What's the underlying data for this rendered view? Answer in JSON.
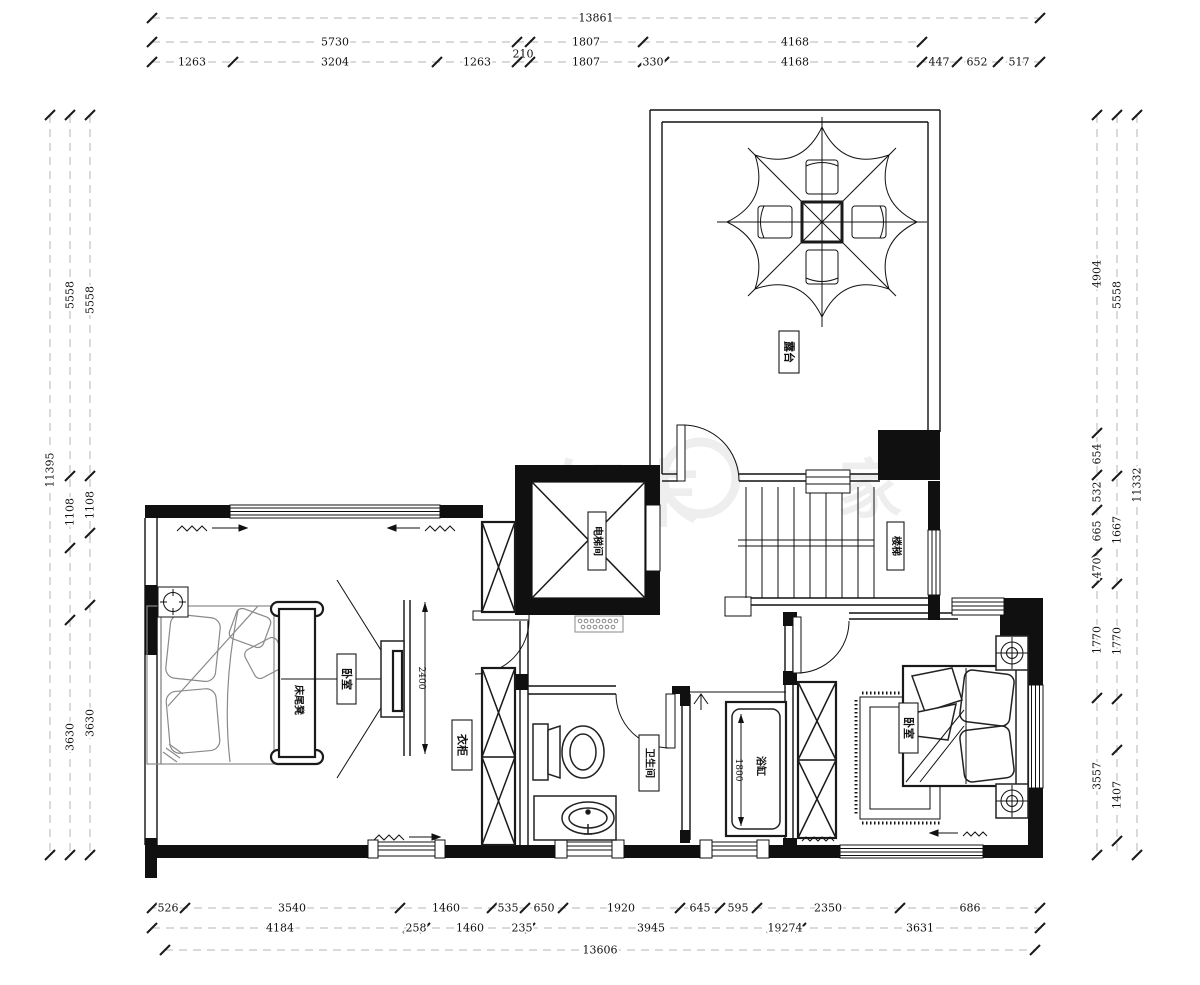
{
  "watermark": {
    "brand": "知末",
    "char": "家"
  },
  "labels": {
    "terrace": "露台",
    "elevator": "电梯间",
    "stairs": "楼梯",
    "bench": "床尾凳",
    "bedroom_left": "卧室",
    "wardrobe": "衣柜",
    "bathroom": "卫生间",
    "bathtub": "浴缸",
    "bedroom_right": "卧室",
    "tv_dim": "2400",
    "tub_dim": "1800"
  },
  "dimensions": {
    "horizontal": [
      {
        "y": 18,
        "x1": 152,
        "x2": 1040,
        "ticks": [
          152,
          1040
        ],
        "labels": [
          {
            "v": "13861",
            "x": 596
          }
        ]
      },
      {
        "y": 42,
        "x1": 152,
        "x2": 922,
        "ticks": [
          152,
          517,
          530,
          643,
          922
        ],
        "labels": [
          {
            "v": "5730",
            "x": 335
          },
          {
            "v": "210",
            "x": 523,
            "dy": 12
          },
          {
            "v": "1807",
            "x": 586
          },
          {
            "v": "4168",
            "x": 795
          }
        ]
      },
      {
        "y": 62,
        "x1": 152,
        "x2": 1040,
        "ticks": [
          152,
          233,
          437,
          517,
          530,
          643,
          664,
          922,
          957,
          998,
          1040
        ],
        "labels": [
          {
            "v": "1263",
            "x": 192
          },
          {
            "v": "3204",
            "x": 335
          },
          {
            "v": "1263",
            "x": 477
          },
          {
            "v": "1807",
            "x": 586
          },
          {
            "v": "330",
            "x": 653
          },
          {
            "v": "4168",
            "x": 795
          },
          {
            "v": "447",
            "x": 939
          },
          {
            "v": "652",
            "x": 977
          },
          {
            "v": "517",
            "x": 1019
          }
        ]
      },
      {
        "y": 908,
        "x1": 152,
        "x2": 1040,
        "ticks": [
          152,
          185,
          400,
          492,
          525,
          563,
          680,
          720,
          757,
          900,
          1040
        ],
        "labels": [
          {
            "v": "526",
            "x": 168
          },
          {
            "v": "3540",
            "x": 292
          },
          {
            "v": "1460",
            "x": 446
          },
          {
            "v": "535",
            "x": 508
          },
          {
            "v": "650",
            "x": 544
          },
          {
            "v": "1920",
            "x": 621
          },
          {
            "v": "645",
            "x": 700
          },
          {
            "v": "595",
            "x": 738
          },
          {
            "v": "2350",
            "x": 828
          },
          {
            "v": "686",
            "x": 970
          }
        ]
      },
      {
        "y": 928,
        "x1": 152,
        "x2": 1040,
        "ticks": [
          152,
          408,
          425,
          515,
          530,
          772,
          784,
          801,
          1040
        ],
        "labels": [
          {
            "v": "4184",
            "x": 280
          },
          {
            "v": "258",
            "x": 416
          },
          {
            "v": "1460",
            "x": 470
          },
          {
            "v": "235",
            "x": 522
          },
          {
            "v": "3945",
            "x": 651
          },
          {
            "v": "192",
            "x": 778
          },
          {
            "v": "274",
            "x": 792
          },
          {
            "v": "3631",
            "x": 920
          }
        ]
      },
      {
        "y": 950,
        "x1": 165,
        "x2": 1035,
        "ticks": [
          165,
          1035
        ],
        "labels": [
          {
            "v": "13606",
            "x": 600
          }
        ]
      }
    ],
    "vertical": [
      {
        "x": 50,
        "y1": 115,
        "y2": 855,
        "ticks": [
          115,
          855
        ],
        "labels": [
          {
            "v": "11395",
            "y": 470
          }
        ]
      },
      {
        "x": 70,
        "y1": 115,
        "y2": 855,
        "ticks": [
          115,
          476,
          548,
          620,
          855
        ],
        "labels": [
          {
            "v": "5558",
            "y": 295
          },
          {
            "v": "1108",
            "y": 512
          },
          {
            "v": "3630",
            "y": 737
          }
        ]
      },
      {
        "x": 90,
        "y1": 115,
        "y2": 855,
        "ticks": [
          115,
          476,
          533,
          605,
          855
        ],
        "labels": [
          {
            "v": "5558",
            "y": 300
          },
          {
            "v": "1108",
            "y": 505
          },
          {
            "v": "3630",
            "y": 723
          }
        ]
      },
      {
        "x": 1097,
        "y1": 115,
        "y2": 855,
        "ticks": [
          115,
          433,
          475,
          510,
          553,
          583,
          698,
          855
        ],
        "labels": [
          {
            "v": "4904",
            "y": 274
          },
          {
            "v": "654",
            "y": 454
          },
          {
            "v": "532",
            "y": 492
          },
          {
            "v": "665",
            "y": 531
          },
          {
            "v": "470",
            "y": 568
          },
          {
            "v": "1770",
            "y": 640
          },
          {
            "v": "3557",
            "y": 776
          }
        ]
      },
      {
        "x": 1117,
        "y1": 115,
        "y2": 855,
        "ticks": [
          115,
          476,
          584,
          699,
          750,
          841
        ],
        "labels": [
          {
            "v": "5558",
            "y": 295
          },
          {
            "v": "1667",
            "y": 530
          },
          {
            "v": "1770",
            "y": 641
          },
          {
            "v": "1407",
            "y": 795
          }
        ]
      },
      {
        "x": 1137,
        "y1": 115,
        "y2": 855,
        "ticks": [
          115,
          855
        ],
        "labels": [
          {
            "v": "11332",
            "y": 485
          }
        ]
      }
    ]
  }
}
